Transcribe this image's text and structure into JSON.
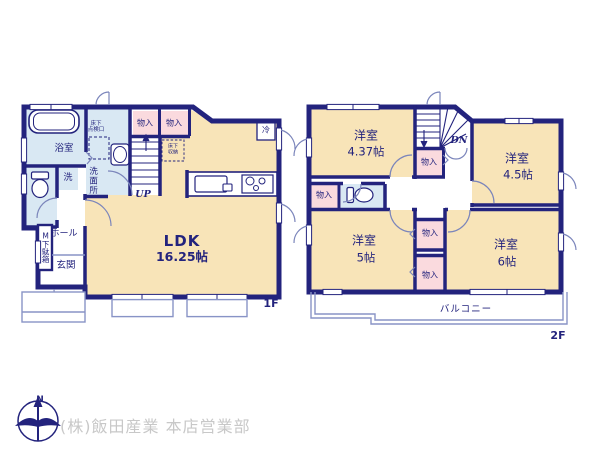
{
  "colors": {
    "wall_navy": "#23237d",
    "room_cream": "#f8e4b8",
    "closet_pink": "#fadade",
    "wet_blue": "#d9e8f3",
    "light_line": "#8893c6",
    "footer_gray": "#c8c8c8"
  },
  "floor1": {
    "floor_label": "1F",
    "bath": "浴室",
    "inspection_line1": "床下",
    "inspection_line2": "点検口",
    "washer": "洗",
    "washroom": "洗面所",
    "closet_a": "物入",
    "closet_b": "物入",
    "fridge": "冷",
    "underfloor_line1": "床下",
    "underfloor_line2": "収納",
    "stairs": "UP",
    "ldk_name": "LDK",
    "ldk_area": "16.25帖",
    "shoe_cabinet": "M下駄箱",
    "hall": "ホール",
    "entrance": "玄関"
  },
  "floor2": {
    "floor_label": "2F",
    "room_nw_name": "洋室",
    "room_nw_area": "4.37帖",
    "room_ne_name": "洋室",
    "room_ne_area": "4.5帖",
    "room_sw_name": "洋室",
    "room_sw_area": "5帖",
    "room_se_name": "洋室",
    "room_se_area": "6帖",
    "closet_west": "物入",
    "closet_stairs": "物入",
    "closet_mid_upper": "物入",
    "closet_mid_lower": "物入",
    "stairs": "DN",
    "balcony": "バルコニー"
  },
  "footer": {
    "compass_north": "N",
    "company": "(株)飯田産業 本店営業部"
  }
}
